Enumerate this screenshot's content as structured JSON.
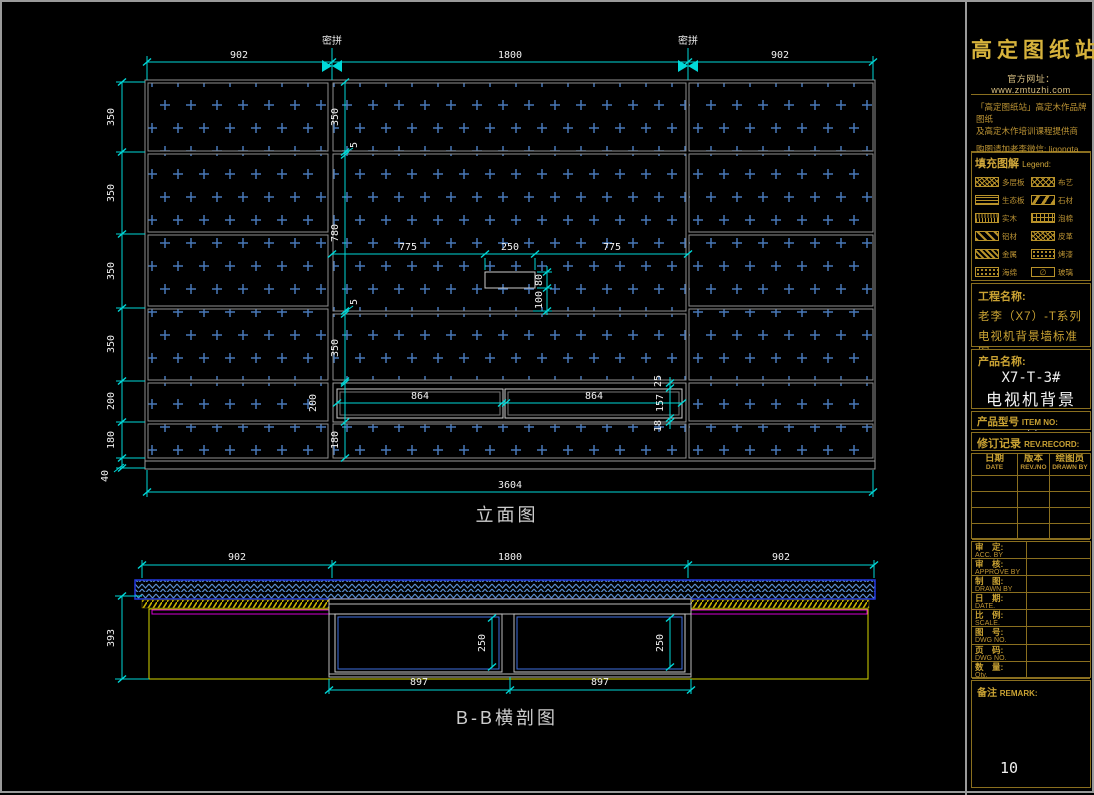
{
  "title_block": {
    "brand": "高定图纸站",
    "website": "官方网址： www.zmtuzhi.com",
    "promo_line1": "「高定图纸站」高定木作品牌图纸",
    "promo_line2": "及高定木作培训课程提供商",
    "promo_line3": "购图请加老李微信: ligongta",
    "legend_title": "填充图解",
    "legend_title_en": "Legend:",
    "legend_items": [
      {
        "label": "多层板"
      },
      {
        "label": "布艺"
      },
      {
        "label": "生态板"
      },
      {
        "label": "石材"
      },
      {
        "label": "实木"
      },
      {
        "label": "泡棉"
      },
      {
        "label": "铝材"
      },
      {
        "label": "皮革"
      },
      {
        "label": "金属"
      },
      {
        "label": "烤漆"
      },
      {
        "label": "海绵"
      },
      {
        "label": "玻璃",
        "symbol": "∅"
      }
    ],
    "project_label": "工程名称:",
    "project_line1": "老李（X7）-T系列",
    "project_line2": "电视机背景墙标准图",
    "product_label": "产品名称:",
    "product_code": "X7-T-3#",
    "product_name": "电视机背景墙",
    "item_no_cn": "产品型号",
    "item_no_en": "ITEM NO:",
    "rev_record_cn": "修订记录",
    "rev_record_en": "REV.RECORD:",
    "rev_headers": [
      {
        "cn": "日期",
        "en": "DATE"
      },
      {
        "cn": "版本",
        "en": "REV./NO"
      },
      {
        "cn": "绘图员",
        "en": "DRAWN BY"
      }
    ],
    "info_rows": [
      {
        "cn": "审　定:",
        "en": "ACC. BY"
      },
      {
        "cn": "审　核:",
        "en": "APPROVE BY"
      },
      {
        "cn": "制　图:",
        "en": "DRAWN BY"
      },
      {
        "cn": "日　期:",
        "en": "DATE."
      },
      {
        "cn": "比　例:",
        "en": "SCALE."
      },
      {
        "cn": "图　号:",
        "en": "DWG NO."
      },
      {
        "cn": "页　码:",
        "en": "DWG NO."
      },
      {
        "cn": "数　量:",
        "en": "Qty."
      }
    ],
    "remark_cn": "备注",
    "remark_en": "REMARK:",
    "page_number": "10"
  },
  "elevation": {
    "title": "立面图",
    "seam_label": "密拼",
    "top_dims": [
      "902",
      "1800",
      "902"
    ],
    "left_dims": [
      "350",
      "350",
      "350",
      "350",
      "200",
      "180",
      "40"
    ],
    "center_dims": [
      "350",
      "5",
      "780",
      "5",
      "350"
    ],
    "mid_dims": [
      "775",
      "250",
      "775"
    ],
    "outlet_dims": [
      "80",
      "100"
    ],
    "cabinet_dims": [
      "864",
      "864"
    ],
    "cabinet_right_dims": [
      "25",
      "157",
      "18"
    ],
    "inner_dims": [
      "200",
      "180"
    ],
    "overall_dim": "3604"
  },
  "section": {
    "title": "B-B横剖图",
    "top_dims": [
      "902",
      "1800",
      "902"
    ],
    "compartment_dims": [
      "250",
      "250"
    ],
    "bottom_dims": [
      "897",
      "897"
    ],
    "left_dim": "393"
  },
  "colors": {
    "dim_line": "#00d8d8",
    "hatch_cross": "#4878b8",
    "panel_line": "#8f8f8f",
    "gold": "#c9a233",
    "section_band_blue": "#2338e0",
    "section_hatch_yellow": "#c9b500",
    "magenta": "#d400d4"
  }
}
